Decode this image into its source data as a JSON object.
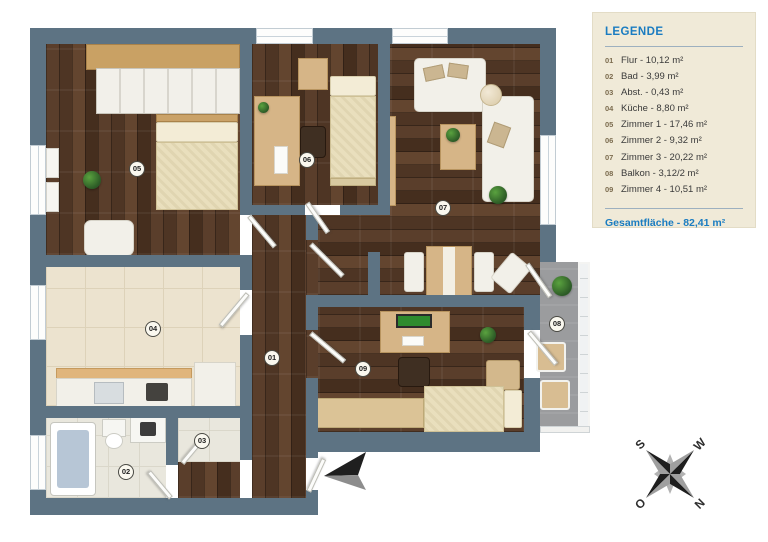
{
  "legend": {
    "title": "LEGENDE",
    "items": [
      {
        "num": "01",
        "label": "Flur - 10,12 m²"
      },
      {
        "num": "02",
        "label": "Bad - 3,99 m²"
      },
      {
        "num": "03",
        "label": "Abst. - 0,43 m²"
      },
      {
        "num": "04",
        "label": "Küche - 8,80 m²"
      },
      {
        "num": "05",
        "label": "Zimmer 1 - 17,46 m²"
      },
      {
        "num": "06",
        "label": "Zimmer 2 - 9,32 m²"
      },
      {
        "num": "07",
        "label": "Zimmer 3 - 20,22 m²"
      },
      {
        "num": "08",
        "label": "Balkon - 3,12/2 m²"
      },
      {
        "num": "09",
        "label": "Zimmer 4 - 10,51 m²"
      }
    ],
    "total": "Gesamtfläche - 82,41 m²"
  },
  "plan": {
    "markers": [
      {
        "id": "01",
        "x": 272,
        "y": 358
      },
      {
        "id": "02",
        "x": 126,
        "y": 472
      },
      {
        "id": "03",
        "x": 202,
        "y": 441
      },
      {
        "id": "04",
        "x": 153,
        "y": 329
      },
      {
        "id": "05",
        "x": 137,
        "y": 169
      },
      {
        "id": "06",
        "x": 307,
        "y": 160
      },
      {
        "id": "07",
        "x": 443,
        "y": 208
      },
      {
        "id": "08",
        "x": 557,
        "y": 324
      },
      {
        "id": "09",
        "x": 363,
        "y": 369
      }
    ]
  },
  "compass": {
    "n": "N",
    "s": "S",
    "o": "O",
    "w": "W"
  },
  "colors": {
    "accent_blue": "#1a7cc1",
    "wall": "#5d7383",
    "legend_bg": "#f0ead8"
  }
}
